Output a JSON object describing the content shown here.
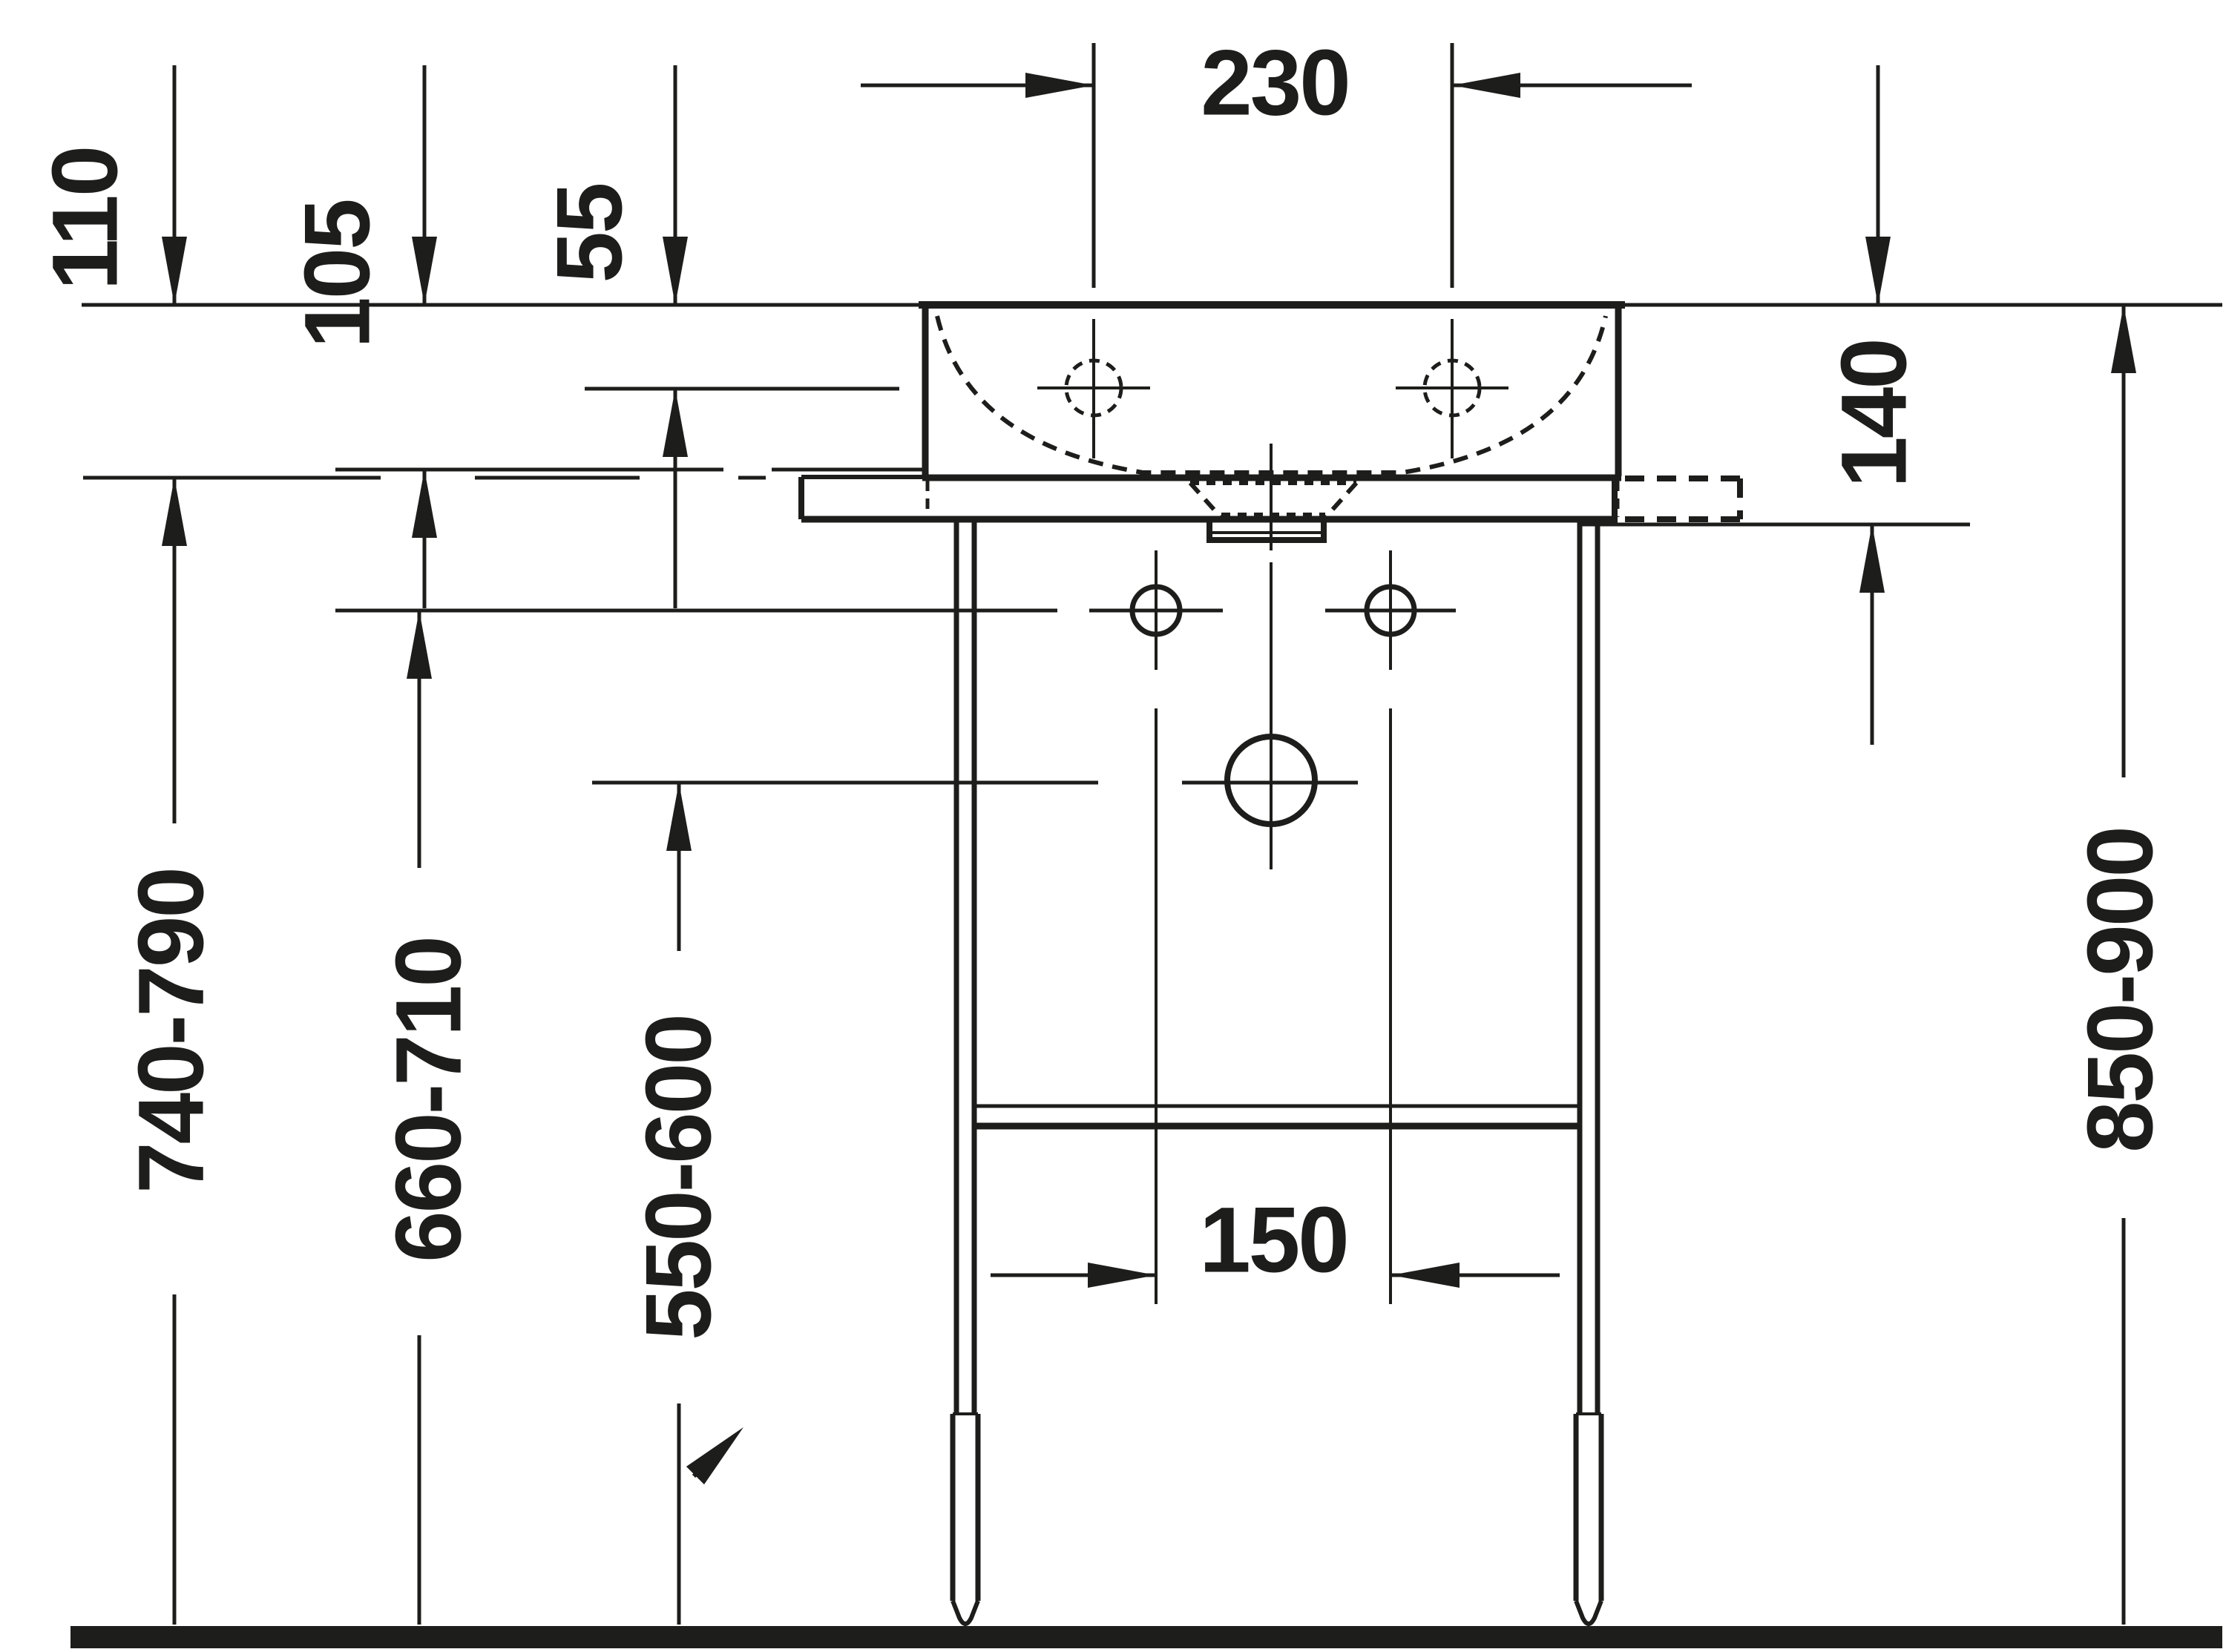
{
  "drawing": {
    "type": "technical-dimension-drawing",
    "subject": "Wall washbasin on metal console stand, front elevation",
    "units": "mm",
    "line_color": "#1d1d1b",
    "background_color": "#ffffff",
    "dimensions": {
      "rim_offsets": [
        {
          "id": "d110",
          "label": "110"
        },
        {
          "id": "d105",
          "label": "105"
        },
        {
          "id": "d55",
          "label": "55"
        }
      ],
      "faucet_hole_spacing": {
        "label": "230"
      },
      "rim_to_console_bottom": {
        "label": "140"
      },
      "floor_to_rim": {
        "label": "850-900"
      },
      "floor_heights": [
        {
          "id": "d740",
          "label": "740-790"
        },
        {
          "id": "d660",
          "label": "660-710"
        },
        {
          "id": "d550",
          "label": "550-600"
        }
      ],
      "fixing_hole_spacing": {
        "label": "150"
      }
    }
  }
}
